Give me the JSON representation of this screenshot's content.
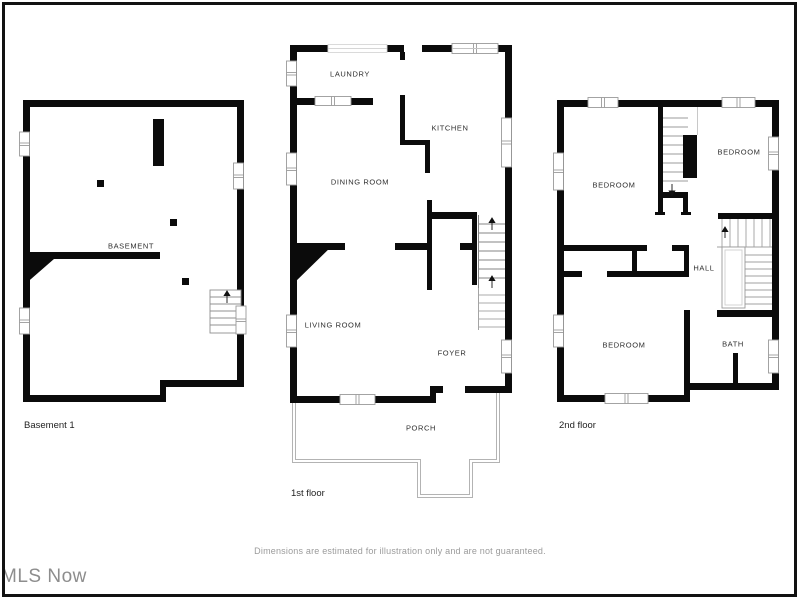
{
  "page": {
    "watermark": "MLS Now",
    "disclaimer": "Dimensions are estimated for illustration only and are not guaranteed."
  },
  "plans": {
    "basement": {
      "floor_label": "Basement 1",
      "rooms": {
        "basement": "BASEMENT"
      }
    },
    "first": {
      "floor_label": "1st floor",
      "rooms": {
        "laundry": "LAUNDRY",
        "kitchen": "KITCHEN",
        "dining": "DINING ROOM",
        "living": "LIVING ROOM",
        "foyer": "FOYER",
        "porch": "PORCH"
      }
    },
    "second": {
      "floor_label": "2nd floor",
      "rooms": {
        "bedroom_top_left": "BEDROOM",
        "bedroom_top_right": "BEDROOM",
        "bedroom_bottom": "BEDROOM",
        "hall": "HALL",
        "bath": "BATH"
      }
    }
  },
  "colors": {
    "wall": "#0b0b0b",
    "window_stroke": "#9a9a9a",
    "stair_stroke": "#909090",
    "porch_stroke": "#b3b3b3",
    "frame": "#111111",
    "label": "#2e2e2e",
    "muted_text": "#9b9b9b",
    "watermark_text": "#8d8d8d"
  }
}
